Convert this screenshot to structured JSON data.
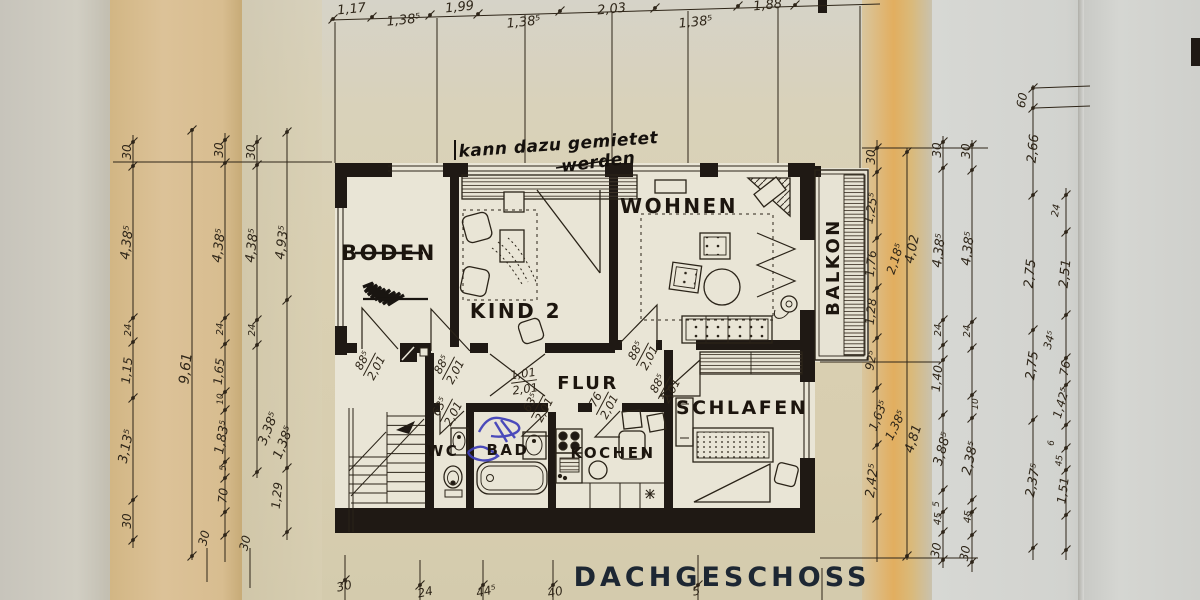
{
  "title": "DACHGESCHOSS",
  "handwritten_note": {
    "line1": "kann dazu gemietet",
    "line2": "werden"
  },
  "rooms": [
    {
      "name": "BODEN",
      "struck_through": true
    },
    {
      "name": "KIND 2"
    },
    {
      "name": "WOHNEN"
    },
    {
      "name": "BALKON"
    },
    {
      "name": "FLUR"
    },
    {
      "name": "SCHLAFEN"
    },
    {
      "name": "WC"
    },
    {
      "name": "BAD"
    },
    {
      "name": "KOCHEN"
    }
  ],
  "door_labels": [
    {
      "top": "88⁵",
      "bottom": "2,01",
      "x": 369,
      "y": 364,
      "r": -62
    },
    {
      "top": "88⁵",
      "bottom": "2,01",
      "x": 448,
      "y": 368,
      "r": -62
    },
    {
      "top": "1,01",
      "bottom": "2,01",
      "x": 524,
      "y": 381,
      "r": -8
    },
    {
      "top": "88⁵",
      "bottom": "2,01",
      "x": 642,
      "y": 354,
      "r": -62
    },
    {
      "top": "88⁵",
      "bottom": "2,01",
      "x": 664,
      "y": 387,
      "r": -62
    },
    {
      "top": "63⁵",
      "bottom": "2,01",
      "x": 446,
      "y": 410,
      "r": -62
    },
    {
      "top": "63⁵",
      "bottom": "2,01",
      "x": 537,
      "y": 406,
      "r": -62
    },
    {
      "top": "76",
      "bottom": "2,01",
      "x": 602,
      "y": 403,
      "r": -62
    }
  ],
  "dim_labels": [
    {
      "t": "1,17",
      "x": 352,
      "y": 13,
      "r": -6
    },
    {
      "t": "1,38⁵",
      "x": 404,
      "y": 24,
      "r": -6
    },
    {
      "t": "1,99",
      "x": 460,
      "y": 11,
      "r": -6
    },
    {
      "t": "1,38⁵",
      "x": 524,
      "y": 26,
      "r": -6
    },
    {
      "t": "2,03",
      "x": 612,
      "y": 13,
      "r": -6
    },
    {
      "t": "1,38⁵",
      "x": 696,
      "y": 26,
      "r": -6
    },
    {
      "t": "1,88",
      "x": 768,
      "y": 9,
      "r": -6
    },
    {
      "t": "30",
      "x": 131,
      "y": 152,
      "r": -90,
      "s": 12
    },
    {
      "t": "4,38⁵",
      "x": 131,
      "y": 243,
      "r": -83
    },
    {
      "t": "24",
      "x": 131,
      "y": 330,
      "r": -90,
      "s": 10
    },
    {
      "t": "1,15",
      "x": 131,
      "y": 371,
      "r": -84,
      "s": 12
    },
    {
      "t": "3,13⁵",
      "x": 130,
      "y": 447,
      "r": -78
    },
    {
      "t": "30",
      "x": 131,
      "y": 521,
      "r": -90,
      "s": 12
    },
    {
      "t": "9,61",
      "x": 190,
      "y": 369,
      "r": -84,
      "s": 14
    },
    {
      "t": "30",
      "x": 208,
      "y": 539,
      "r": -76,
      "s": 12
    },
    {
      "t": "30",
      "x": 223,
      "y": 150,
      "r": -90,
      "s": 12
    },
    {
      "t": "4,38⁵",
      "x": 223,
      "y": 246,
      "r": -83
    },
    {
      "t": "24",
      "x": 223,
      "y": 329,
      "r": -90,
      "s": 10
    },
    {
      "t": "1,65",
      "x": 223,
      "y": 372,
      "r": -84,
      "s": 12
    },
    {
      "t": "10",
      "x": 223,
      "y": 399,
      "r": -90,
      "s": 9
    },
    {
      "t": "1,83⁵",
      "x": 226,
      "y": 438,
      "r": -79
    },
    {
      "t": "5",
      "x": 226,
      "y": 468,
      "r": -90,
      "s": 9
    },
    {
      "t": "70",
      "x": 227,
      "y": 496,
      "r": -84,
      "s": 12
    },
    {
      "t": "30",
      "x": 249,
      "y": 544,
      "r": -76,
      "s": 12
    },
    {
      "t": "30",
      "x": 255,
      "y": 152,
      "r": -90,
      "s": 12
    },
    {
      "t": "4,38⁵",
      "x": 256,
      "y": 246,
      "r": -83
    },
    {
      "t": "24",
      "x": 255,
      "y": 330,
      "r": -90,
      "s": 10
    },
    {
      "t": "3,38⁵",
      "x": 272,
      "y": 430,
      "r": -68
    },
    {
      "t": "4,93⁵",
      "x": 286,
      "y": 243,
      "r": -83
    },
    {
      "t": "1,38⁵",
      "x": 287,
      "y": 444,
      "r": -68
    },
    {
      "t": "1,29",
      "x": 281,
      "y": 496,
      "r": -84,
      "s": 12
    },
    {
      "t": "30",
      "x": 875,
      "y": 157,
      "r": -90,
      "s": 12
    },
    {
      "t": "1,25⁵",
      "x": 875,
      "y": 209,
      "r": -80,
      "s": 12
    },
    {
      "t": "1,76",
      "x": 875,
      "y": 264,
      "r": -84,
      "s": 12
    },
    {
      "t": "1,28",
      "x": 875,
      "y": 312,
      "r": -84,
      "s": 12
    },
    {
      "t": "92⁵",
      "x": 875,
      "y": 361,
      "r": -80,
      "s": 12
    },
    {
      "t": "1,63⁵",
      "x": 882,
      "y": 417,
      "r": -68,
      "s": 12
    },
    {
      "t": "2,42⁵",
      "x": 876,
      "y": 481,
      "r": -83
    },
    {
      "t": "2,18⁵",
      "x": 899,
      "y": 260,
      "r": -72,
      "s": 12
    },
    {
      "t": "4,02",
      "x": 916,
      "y": 250,
      "r": -78,
      "s": 13
    },
    {
      "t": "1,38⁵",
      "x": 899,
      "y": 427,
      "r": -64,
      "s": 12
    },
    {
      "t": "4,81",
      "x": 917,
      "y": 440,
      "r": -72,
      "s": 13
    },
    {
      "t": "30",
      "x": 941,
      "y": 150,
      "r": -90,
      "s": 12
    },
    {
      "t": "4,38⁵",
      "x": 943,
      "y": 251,
      "r": -83
    },
    {
      "t": "24",
      "x": 941,
      "y": 330,
      "r": -90,
      "s": 10
    },
    {
      "t": "1,40",
      "x": 941,
      "y": 379,
      "r": -84,
      "s": 12
    },
    {
      "t": "3,88⁵",
      "x": 946,
      "y": 450,
      "r": -74
    },
    {
      "t": "5",
      "x": 939,
      "y": 504,
      "r": -90,
      "s": 9
    },
    {
      "t": "45",
      "x": 941,
      "y": 519,
      "r": -84,
      "s": 10
    },
    {
      "t": "30",
      "x": 940,
      "y": 551,
      "r": -80,
      "s": 12
    },
    {
      "t": "30",
      "x": 970,
      "y": 151,
      "r": -90,
      "s": 12
    },
    {
      "t": "4,38⁵",
      "x": 972,
      "y": 249,
      "r": -83
    },
    {
      "t": "24",
      "x": 970,
      "y": 331,
      "r": -90,
      "s": 10
    },
    {
      "t": "10",
      "x": 978,
      "y": 404,
      "r": -90,
      "s": 9
    },
    {
      "t": "2,38⁵",
      "x": 974,
      "y": 459,
      "r": -77
    },
    {
      "t": "45",
      "x": 971,
      "y": 517,
      "r": -84,
      "s": 10
    },
    {
      "t": "30",
      "x": 969,
      "y": 554,
      "r": -80,
      "s": 12
    },
    {
      "t": "60",
      "x": 1026,
      "y": 101,
      "r": -80,
      "s": 12
    },
    {
      "t": "2,66",
      "x": 1037,
      "y": 149,
      "r": -84,
      "s": 13
    },
    {
      "t": "2,75",
      "x": 1034,
      "y": 274,
      "r": -84,
      "s": 13
    },
    {
      "t": "2,75",
      "x": 1036,
      "y": 366,
      "r": -82,
      "s": 13
    },
    {
      "t": "2,37⁵",
      "x": 1037,
      "y": 481,
      "r": -79
    },
    {
      "t": "24",
      "x": 1059,
      "y": 211,
      "r": -80,
      "s": 10
    },
    {
      "t": "2,51",
      "x": 1069,
      "y": 274,
      "r": -84,
      "s": 13
    },
    {
      "t": "34⁵",
      "x": 1053,
      "y": 341,
      "r": -74,
      "s": 11
    },
    {
      "t": "76",
      "x": 1069,
      "y": 369,
      "r": -80,
      "s": 12
    },
    {
      "t": "1,42⁵",
      "x": 1065,
      "y": 404,
      "r": -74,
      "s": 12
    },
    {
      "t": "6",
      "x": 1054,
      "y": 443,
      "r": -90,
      "s": 9
    },
    {
      "t": "45",
      "x": 1062,
      "y": 461,
      "r": -84,
      "s": 9
    },
    {
      "t": "1,51",
      "x": 1067,
      "y": 491,
      "r": -82,
      "s": 12
    },
    {
      "t": "30",
      "x": 345,
      "y": 590,
      "r": -12,
      "s": 12
    },
    {
      "t": "24",
      "x": 426,
      "y": 596,
      "r": -12,
      "s": 12
    },
    {
      "t": "44⁵",
      "x": 487,
      "y": 595,
      "r": -12,
      "s": 12
    },
    {
      "t": "40",
      "x": 556,
      "y": 596,
      "r": -12,
      "s": 12
    },
    {
      "t": "5",
      "x": 697,
      "y": 595,
      "r": -12,
      "s": 12
    }
  ],
  "colors": {
    "paper_tan": "#dcbf8e",
    "paper_center": "#d9d0b4",
    "paper_right": "#d3d4d0",
    "fold_orange": "#e0ad5f",
    "plan_interior": "#e9e5d6",
    "ink": "#2a2318",
    "wall_black": "#1f1914",
    "blue_ink": "#3d3db8",
    "title_ink": "#1d2733"
  }
}
